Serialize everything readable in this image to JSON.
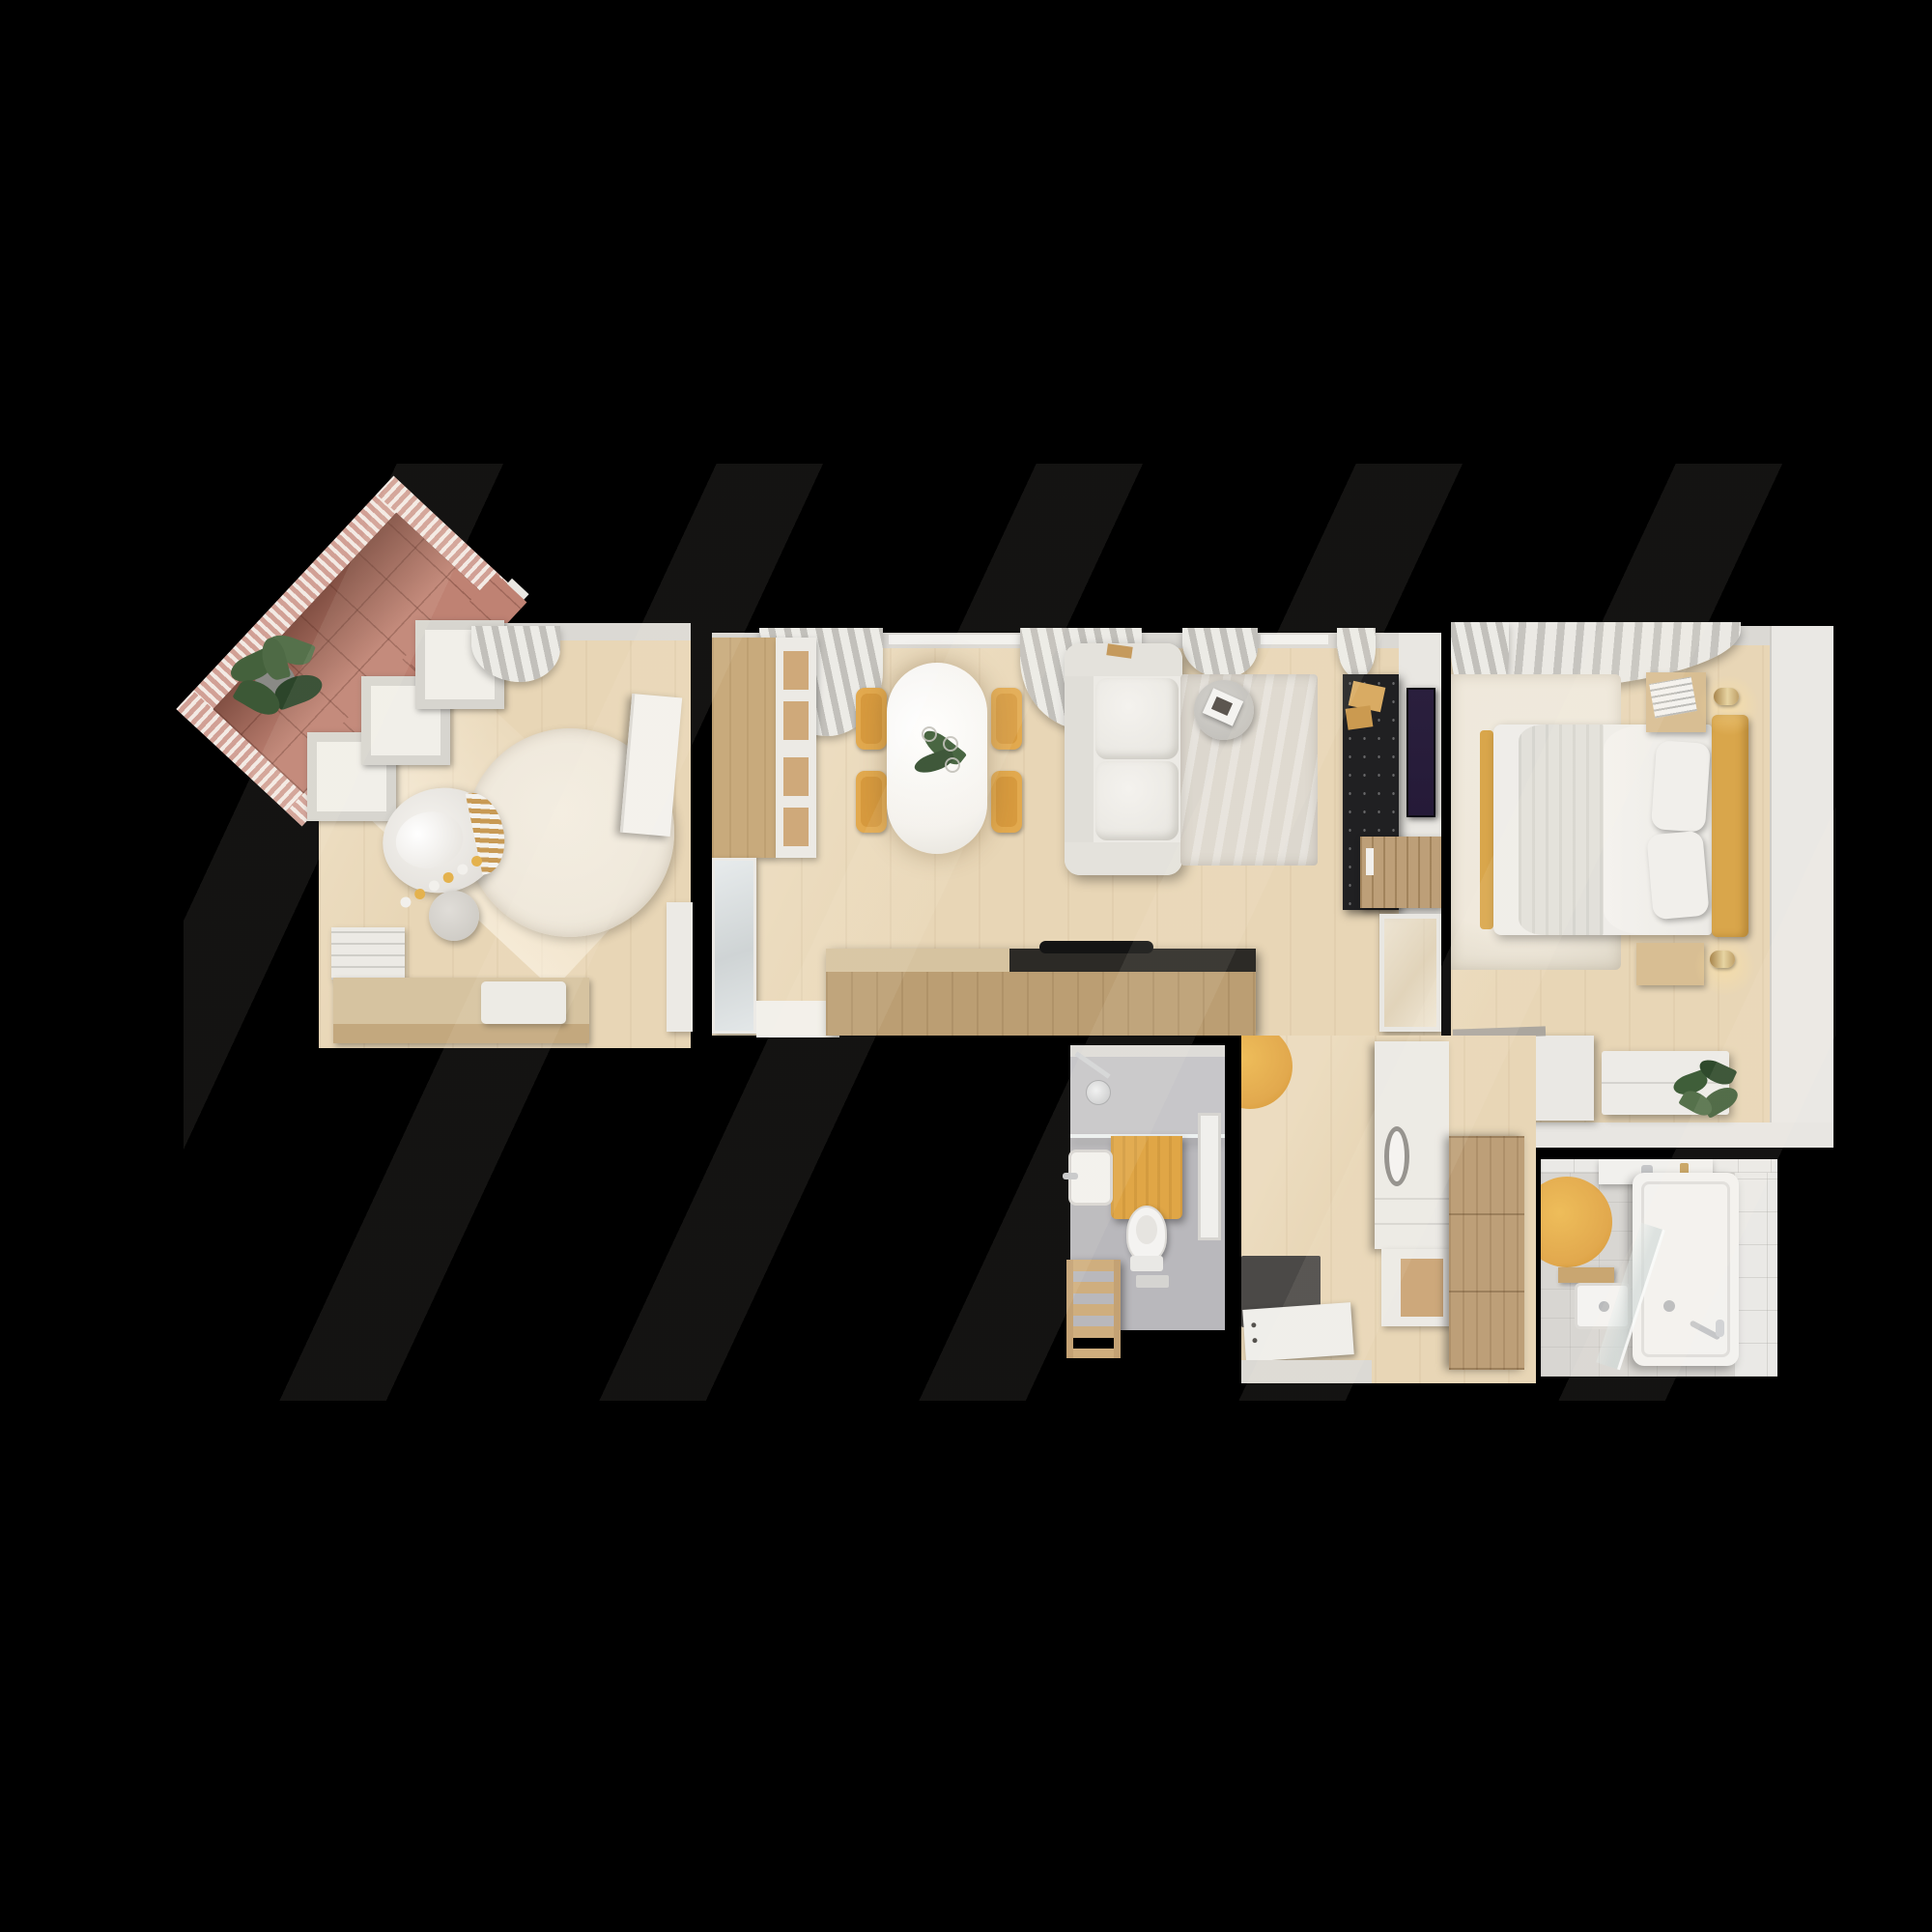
{
  "meta": {
    "scene": "apartment-floor-plan-top-down-3d-render",
    "view": "bird-eye",
    "background": "black",
    "visible_text": ""
  },
  "colors": {
    "bg": "#000000",
    "railing_pink": "#d1a095",
    "tile_floor": "#bf8273",
    "plant_green": "#44613c",
    "plant_dark": "#2c452a",
    "wood_floor": "#e8d6b6",
    "rug_cream": "#efe8db",
    "rug_grey": "#dcd7ce",
    "cabinet_wood": "#c8aa7c",
    "island_wood": "#bb9e73",
    "island_top": "#d6c3a0",
    "counter_dark": "#2c2a26",
    "furn_white": "#eceae5",
    "chair_yellow": "#e2a94e",
    "mustard": "#d9a64b",
    "console_black": "#202022",
    "tv_screen": "#251a38",
    "wall_light": "#dbd9d4",
    "bath_floor": "#b9b8bc",
    "towel_yellow": "#e0a646",
    "tile_wall": "#eae9e6",
    "mat_dark": "#4b4947",
    "wardrobe_wood": "#bd9f78",
    "brass": "#c7a15e"
  },
  "rooms": [
    {
      "name": "balcony",
      "furniture": [
        "slatted-railing",
        "terracotta-tile-floor",
        "potted-plant",
        "parapet-wall"
      ]
    },
    {
      "name": "nursery",
      "furniture": [
        "bay-window-panels",
        "pink-window-sill",
        "round-rug",
        "round-crib",
        "toy-garland",
        "pouf",
        "dresser-changing-table",
        "changing-pad",
        "folded-blankets",
        "wardrobe",
        "open-door",
        "curtain"
      ]
    },
    {
      "name": "living-room-kitchen",
      "furniture": [
        "curtains",
        "window-sill",
        "tall-wood-cabinet",
        "open-shelf-unit",
        "glass-front-cabinet",
        "kitchen-island",
        "black-hob-counter",
        "dining-table",
        "dining-chairs",
        "table-plant",
        "sofa",
        "area-rug",
        "round-side-table",
        "tv-console",
        "wall-tv",
        "slatted-sideboard",
        "glazed-door"
      ]
    },
    {
      "name": "bedroom",
      "furniture": [
        "curtain-swoosh",
        "window-sill",
        "area-rug",
        "double-bed",
        "folded-blanket",
        "pillows",
        "mustard-headboard",
        "nightstand-top",
        "nightstand-bottom",
        "wall-sconce-top",
        "wall-sconce-bottom",
        "magazine",
        "desk",
        "drawer-unit",
        "potted-plant"
      ]
    },
    {
      "name": "bathroom-wc",
      "furniture": [
        "shower-head",
        "glass-screen",
        "mustard-towel",
        "wash-basin",
        "faucet",
        "toilet",
        "floor-drain",
        "ladder-shelf",
        "leaning-mirror"
      ]
    },
    {
      "name": "hallway",
      "furniture": [
        "yellow-round-rug",
        "washer-column",
        "storage-cabinet",
        "open-wood-niche",
        "wood-wardrobe",
        "doormat",
        "front-door",
        "door-threshold"
      ]
    },
    {
      "name": "bathroom-main",
      "furniture": [
        "yellow-round-rug",
        "vanity-counter",
        "vanity-faucet",
        "gold-bottle",
        "wood-bench",
        "wash-basin",
        "glass-screen",
        "bathtub",
        "hand-shower"
      ]
    }
  ],
  "counts": {
    "dining_chairs": 4,
    "bay_window_panels": 3,
    "bed_pillows": 2,
    "curtain_clusters_living": 4
  }
}
